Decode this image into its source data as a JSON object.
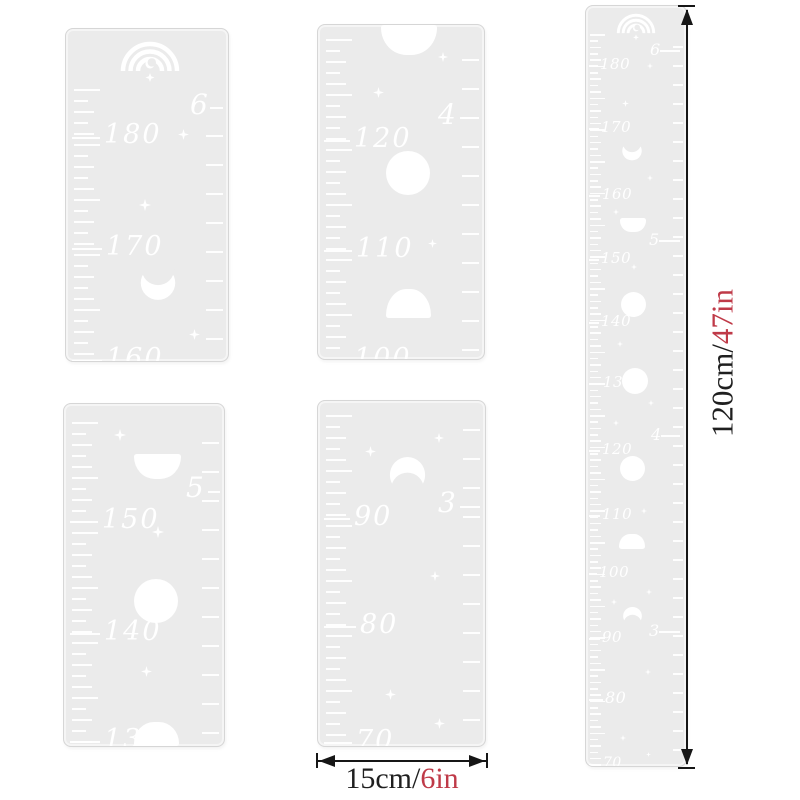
{
  "colors": {
    "page_bg": "#ffffff",
    "panel_bg": "#ebebeb",
    "panel_border": "#d6d6d6",
    "mark": "#ffffff",
    "dim_line": "#161616",
    "dim_text": "#1f1f1f",
    "dim_accent": "#bf3a48"
  },
  "dim_right": {
    "black": "120cm/",
    "red": "47in"
  },
  "dim_bottom": {
    "black": "15cm/",
    "red": "6in"
  },
  "panels": [
    {
      "name": "segment-180-160",
      "rect": [
        65,
        28,
        162,
        332
      ],
      "ticks": {
        "left": [
          60,
          328,
          11
        ],
        "right": [
          106,
          328,
          29
        ]
      },
      "els": [
        [
          "rainbow",
          52,
          4,
          64,
          50
        ],
        [
          "foot",
          "6",
          124,
          62,
          28
        ],
        [
          "hline",
          144,
          157,
          78
        ],
        [
          "label",
          "180",
          38,
          92,
          27
        ],
        [
          "hline",
          6,
          34,
          108
        ],
        [
          "star",
          112,
          100,
          11
        ],
        [
          "star",
          73,
          170,
          12
        ],
        [
          "label",
          "170",
          40,
          204,
          27
        ],
        [
          "hline",
          6,
          36,
          219
        ],
        [
          "moon",
          "cres-up",
          69,
          238,
          46,
          34
        ],
        [
          "star",
          123,
          300,
          11
        ],
        [
          "label",
          "160",
          40,
          316,
          27
        ],
        [
          "hline",
          6,
          36,
          331
        ]
      ]
    },
    {
      "name": "segment-120-100",
      "rect": [
        317,
        24,
        166,
        334
      ],
      "ticks": {
        "left": [
          14,
          330,
          11
        ],
        "right": [
          34,
          330,
          29
        ]
      },
      "els": [
        [
          "moon",
          "dome-down",
          63,
          0,
          56,
          30
        ],
        [
          "star",
          120,
          27,
          10
        ],
        [
          "star",
          55,
          62,
          11
        ],
        [
          "foot",
          "4",
          120,
          76,
          28
        ],
        [
          "hline",
          142,
          161,
          92
        ],
        [
          "label",
          "120",
          36,
          100,
          27
        ],
        [
          "hline",
          6,
          32,
          115
        ],
        [
          "moon",
          "full",
          68,
          126,
          44,
          44
        ],
        [
          "label",
          "110",
          38,
          210,
          27
        ],
        [
          "hline",
          6,
          34,
          225
        ],
        [
          "star",
          110,
          214,
          9
        ],
        [
          "moon",
          "dome-up",
          68,
          264,
          45,
          29
        ],
        [
          "label",
          "100",
          36,
          320,
          27
        ],
        [
          "hline",
          6,
          32,
          335
        ]
      ]
    },
    {
      "name": "segment-150-130",
      "rect": [
        63,
        403,
        160,
        342
      ],
      "ticks": {
        "left": [
          18,
          338,
          11
        ],
        "right": [
          38,
          338,
          29
        ]
      },
      "els": [
        [
          "star",
          50,
          25,
          12
        ],
        [
          "moon",
          "dome-down",
          70,
          50,
          47,
          25
        ],
        [
          "foot",
          "5",
          122,
          70,
          28
        ],
        [
          "hline",
          144,
          156,
          87
        ],
        [
          "label",
          "150",
          38,
          102,
          27
        ],
        [
          "hline",
          6,
          34,
          117
        ],
        [
          "star",
          88,
          122,
          12
        ],
        [
          "moon",
          "full",
          70,
          175,
          44,
          44
        ],
        [
          "label",
          "140",
          40,
          214,
          27
        ],
        [
          "hline",
          6,
          36,
          229
        ],
        [
          "star",
          77,
          262,
          11
        ],
        [
          "label",
          "130",
          40,
          322,
          27
        ],
        [
          "hline",
          6,
          36,
          337
        ],
        [
          "moon",
          "dome-up",
          70,
          318,
          45,
          24
        ]
      ]
    },
    {
      "name": "segment-90-70",
      "rect": [
        317,
        400,
        167,
        345
      ],
      "ticks": {
        "left": [
          14,
          340,
          11
        ],
        "right": [
          28,
          340,
          29
        ]
      },
      "els": [
        [
          "star",
          116,
          32,
          10
        ],
        [
          "star",
          47,
          45,
          11
        ],
        [
          "moon",
          "cres-down",
          66,
          56,
          47,
          36
        ],
        [
          "foot",
          "3",
          120,
          88,
          28
        ],
        [
          "hline",
          142,
          162,
          105
        ],
        [
          "label",
          "90",
          36,
          102,
          27
        ],
        [
          "hline",
          6,
          32,
          117
        ],
        [
          "star",
          112,
          170,
          10
        ],
        [
          "label",
          "80",
          42,
          210,
          27
        ],
        [
          "hline",
          6,
          38,
          225
        ],
        [
          "star",
          67,
          288,
          11
        ],
        [
          "star",
          116,
          317,
          11
        ],
        [
          "label",
          "70",
          38,
          326,
          27
        ],
        [
          "hline",
          6,
          34,
          341
        ]
      ]
    },
    {
      "name": "full-ruler-120cm",
      "rect": [
        585,
        5,
        100,
        760
      ],
      "tiny": true,
      "ticks": {
        "left": [
          28,
          756,
          6.35
        ],
        "right": [
          40,
          756,
          19
        ]
      },
      "els": [
        [
          "rainbow",
          29,
          2,
          42,
          33
        ],
        [
          "foot",
          "6",
          64,
          36,
          16
        ],
        [
          "hline",
          74,
          94,
          44
        ],
        [
          "label",
          "180",
          14,
          51,
          15
        ],
        [
          "hline",
          3,
          12,
          59
        ],
        [
          "star",
          61,
          57,
          6
        ],
        [
          "star",
          36,
          94,
          7
        ],
        [
          "label",
          "170",
          15,
          114,
          15
        ],
        [
          "hline",
          3,
          13,
          122
        ],
        [
          "moon",
          "cres-up",
          33,
          136,
          26,
          19
        ],
        [
          "star",
          61,
          169,
          6
        ],
        [
          "label",
          "160",
          16,
          181,
          15
        ],
        [
          "hline",
          3,
          14,
          189
        ],
        [
          "star",
          27,
          203,
          6
        ],
        [
          "moon",
          "dome-down",
          34,
          212,
          26,
          14
        ],
        [
          "foot",
          "5",
          63,
          226,
          16
        ],
        [
          "hline",
          73,
          94,
          234
        ],
        [
          "label",
          "150",
          15,
          245,
          15
        ],
        [
          "hline",
          3,
          13,
          253
        ],
        [
          "star",
          45,
          258,
          6
        ],
        [
          "moon",
          "full",
          35,
          286,
          25,
          25
        ],
        [
          "label",
          "140",
          15,
          308,
          15
        ],
        [
          "hline",
          3,
          13,
          316
        ],
        [
          "star",
          31,
          335,
          6
        ],
        [
          "label",
          "130",
          17,
          369,
          15
        ],
        [
          "hline",
          3,
          15,
          377
        ],
        [
          "moon",
          "full",
          36,
          362,
          26,
          26
        ],
        [
          "star",
          62,
          394,
          6
        ],
        [
          "star",
          27,
          414,
          6
        ],
        [
          "foot",
          "4",
          65,
          421,
          16
        ],
        [
          "hline",
          75,
          94,
          429
        ],
        [
          "label",
          "120",
          16,
          436,
          15
        ],
        [
          "hline",
          3,
          14,
          444
        ],
        [
          "moon",
          "full",
          34,
          450,
          25,
          25
        ],
        [
          "label",
          "110",
          16,
          501,
          15
        ],
        [
          "hline",
          3,
          14,
          509
        ],
        [
          "star",
          55,
          502,
          6
        ],
        [
          "moon",
          "dome-up",
          33,
          528,
          26,
          15
        ],
        [
          "label",
          "100",
          13,
          559,
          15
        ],
        [
          "hline",
          3,
          11,
          567
        ],
        [
          "star",
          60,
          583,
          6
        ],
        [
          "star",
          25,
          593,
          6
        ],
        [
          "moon",
          "cres-down",
          34,
          601,
          25,
          18
        ],
        [
          "foot",
          "3",
          63,
          617,
          16
        ],
        [
          "hline",
          73,
          94,
          625
        ],
        [
          "label",
          "90",
          16,
          624,
          15
        ],
        [
          "hline",
          3,
          14,
          632
        ],
        [
          "star",
          59,
          663,
          6
        ],
        [
          "label",
          "80",
          19,
          684,
          16
        ],
        [
          "hline",
          3,
          17,
          693
        ],
        [
          "star",
          34,
          729,
          6
        ],
        [
          "star",
          60,
          746,
          5
        ],
        [
          "label",
          "70",
          17,
          750,
          14
        ],
        [
          "hline",
          3,
          15,
          758
        ]
      ]
    }
  ]
}
